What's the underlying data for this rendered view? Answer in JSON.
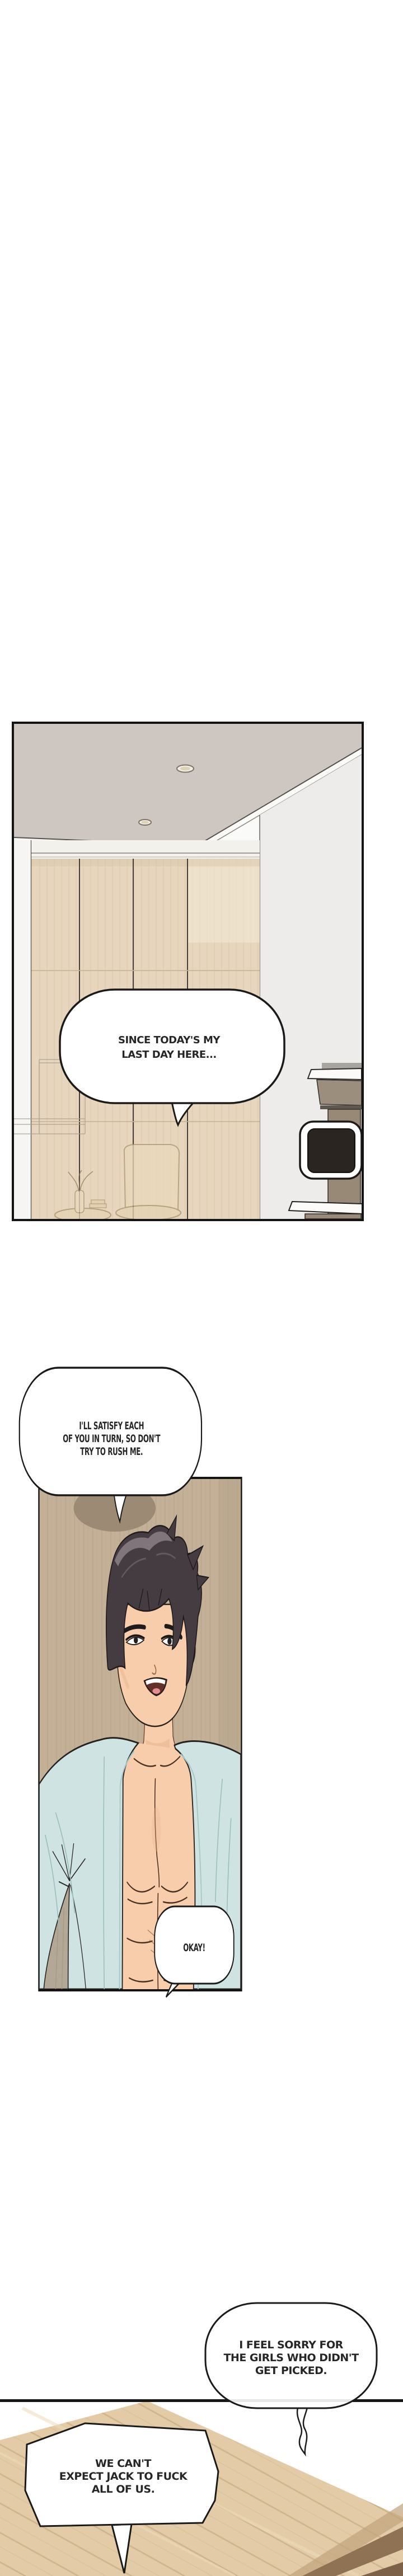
{
  "speech_bubbles": {
    "room": {
      "speaker_visible": false,
      "lines": [
        "SINCE TODAY'S MY",
        "LAST DAY HERE..."
      ]
    },
    "satisfy": {
      "speaker_visible": true,
      "lines": [
        "I'LL SATISFY EACH",
        "OF YOU IN TURN, SO DON'T",
        "TRY TO RUSH ME."
      ]
    },
    "okay": {
      "speaker_visible": false,
      "lines": [
        "OKAY!"
      ]
    },
    "sorry": {
      "speaker_visible": false,
      "lines": [
        "I FEEL SORRY FOR",
        "THE GIRLS WHO DIDN'T",
        "GET PICKED."
      ]
    },
    "expect": {
      "speaker_visible": false,
      "lines": [
        "WE CAN'T",
        "EXPECT JACK TO FUCK",
        "ALL OF US."
      ]
    }
  },
  "colors": {
    "page_background": "#ffffff",
    "panel_border": "#141414",
    "bubble_fill": "#ffffff",
    "bubble_outline": "#1a1a1a",
    "bubble_text": "#262626",
    "ceiling": "#cec7c1",
    "right_wall": "#edecea",
    "curtain": "#e7d6bd",
    "curtain_stripe": "#dcc8ab",
    "media_cabinet": "#9c8e7c",
    "tv_screen": "#2a2521",
    "wood_wall": "#c3b097",
    "wood_wall_grain": "#ab9880",
    "hair": "#453c41",
    "hair_highlight": "#8b7f85",
    "skin": "#f7cdab",
    "robe": "#cfe4e2",
    "robe_fold": "#9cbcbe",
    "floor_wood": "#e2cba6",
    "floor_plank_line": "#c9ad84",
    "floor_dark_stripe": "#8f7154"
  }
}
